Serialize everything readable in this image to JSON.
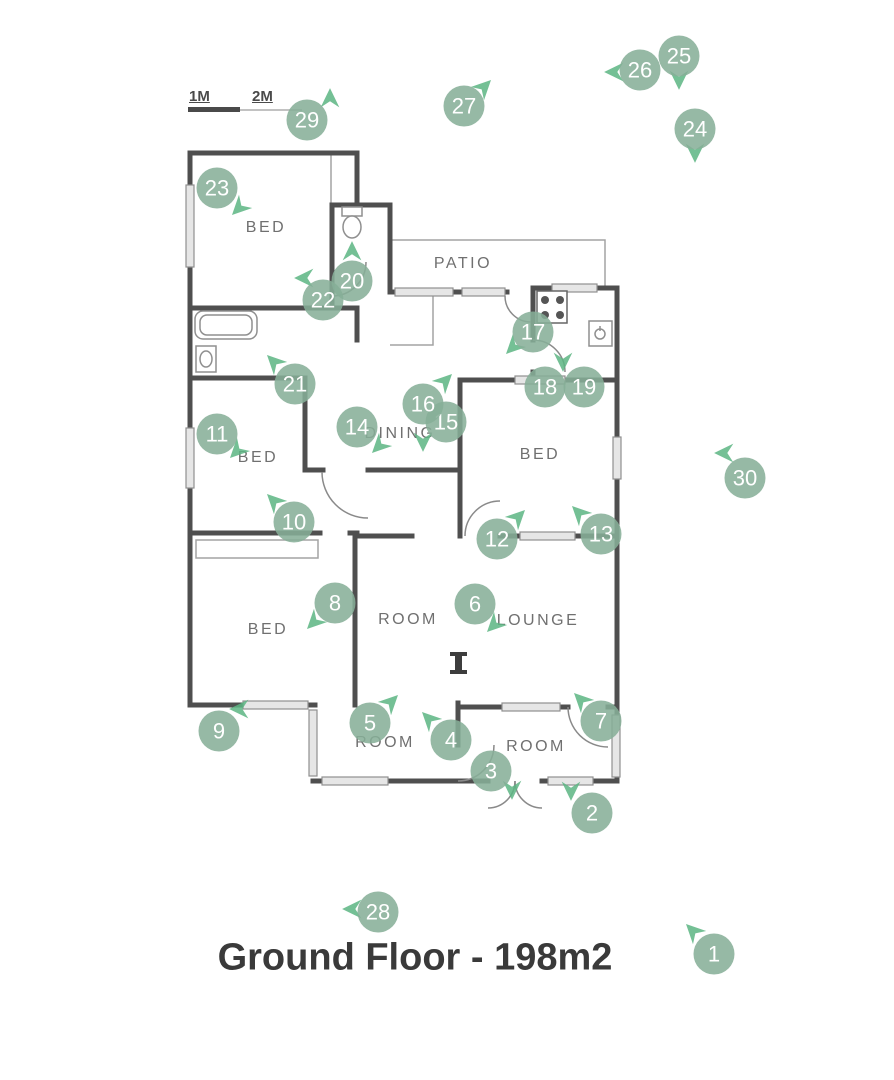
{
  "title": {
    "text": "Ground Floor - 198m2"
  },
  "scale_bar": {
    "label_1m": "1M",
    "label_2m": "2M"
  },
  "colors": {
    "marker_fill": "rgba(134,175,152,0.87)",
    "arrow_fill": "rgba(92,181,131,0.85)",
    "wall": "#4f4f4f",
    "room_label": "#707070",
    "title_text": "#3a3a3a"
  },
  "rooms": [
    {
      "id": "bed-top-left",
      "label": "BED",
      "x": 266,
      "y": 228
    },
    {
      "id": "patio",
      "label": "PATIO",
      "x": 463,
      "y": 264
    },
    {
      "id": "dining",
      "label": "DINING",
      "x": 400,
      "y": 434
    },
    {
      "id": "bed-right",
      "label": "BED",
      "x": 540,
      "y": 455
    },
    {
      "id": "bed-mid-left",
      "label": "BED",
      "x": 258,
      "y": 458
    },
    {
      "id": "bed-bottom-left",
      "label": "BED",
      "x": 268,
      "y": 630
    },
    {
      "id": "room-center",
      "label": "ROOM",
      "x": 408,
      "y": 620
    },
    {
      "id": "lounge",
      "label": "LOUNGE",
      "x": 538,
      "y": 621
    },
    {
      "id": "room-bottom-center",
      "label": "ROOM",
      "x": 385,
      "y": 743
    },
    {
      "id": "room-bottom-right",
      "label": "ROOM",
      "x": 536,
      "y": 747
    }
  ],
  "markers": [
    {
      "n": "1",
      "x": 714,
      "y": 954,
      "arrow": {
        "dx": -21,
        "dy": -23,
        "dir": "NW"
      }
    },
    {
      "n": "2",
      "x": 592,
      "y": 813,
      "arrow": {
        "dx": -21,
        "dy": -22,
        "dir": "S"
      }
    },
    {
      "n": "3",
      "x": 491,
      "y": 771,
      "arrow": {
        "dx": 21,
        "dy": 19,
        "dir": "S"
      }
    },
    {
      "n": "4",
      "x": 451,
      "y": 740,
      "arrow": {
        "dx": -22,
        "dy": -21,
        "dir": "NW"
      }
    },
    {
      "n": "5",
      "x": 370,
      "y": 723,
      "arrow": {
        "dx": 21,
        "dy": -21,
        "dir": "NE"
      }
    },
    {
      "n": "6",
      "x": 475,
      "y": 604,
      "arrow": {
        "dx": 19,
        "dy": 21,
        "dir": "SW"
      }
    },
    {
      "n": "7",
      "x": 601,
      "y": 721,
      "arrow": {
        "dx": -20,
        "dy": -21,
        "dir": "NW"
      }
    },
    {
      "n": "8",
      "x": 335,
      "y": 603,
      "arrow": {
        "dx": -21,
        "dy": 19,
        "dir": "SW"
      }
    },
    {
      "n": "9",
      "x": 219,
      "y": 731,
      "arrow": {
        "dx": 20,
        "dy": -22,
        "dir": "W"
      }
    },
    {
      "n": "10",
      "x": 294,
      "y": 522,
      "arrow": {
        "dx": -20,
        "dy": -21,
        "dir": "NW"
      }
    },
    {
      "n": "11",
      "x": 217,
      "y": 434,
      "arrow": {
        "dx": 20,
        "dy": 17,
        "dir": "SW"
      }
    },
    {
      "n": "12",
      "x": 497,
      "y": 539,
      "arrow": {
        "dx": 21,
        "dy": -22,
        "dir": "NE"
      }
    },
    {
      "n": "13",
      "x": 601,
      "y": 534,
      "arrow": {
        "dx": -22,
        "dy": -21,
        "dir": "NW"
      }
    },
    {
      "n": "14",
      "x": 357,
      "y": 427,
      "arrow": {
        "dx": 22,
        "dy": 19,
        "dir": "SW"
      }
    },
    {
      "n": "15",
      "x": 446,
      "y": 422,
      "arrow": {
        "dx": -23,
        "dy": 20,
        "dir": "S"
      }
    },
    {
      "n": "16",
      "x": 423,
      "y": 404,
      "arrow": {
        "dx": 22,
        "dy": -23,
        "dir": "NE"
      }
    },
    {
      "n": "17",
      "x": 533,
      "y": 332,
      "arrow": {
        "dx": -20,
        "dy": 15,
        "dir": "SW"
      }
    },
    {
      "n": "18",
      "x": 545,
      "y": 387,
      "arrow": {
        "dx": 18,
        "dy": -25,
        "dir": "S"
      }
    },
    {
      "n": "19",
      "x": 584,
      "y": 387,
      "arrow": null
    },
    {
      "n": "20",
      "x": 352,
      "y": 281,
      "arrow": {
        "dx": 0,
        "dy": -30,
        "dir": "N"
      }
    },
    {
      "n": "21",
      "x": 295,
      "y": 384,
      "arrow": {
        "dx": -21,
        "dy": -22,
        "dir": "NW"
      }
    },
    {
      "n": "22",
      "x": 323,
      "y": 300,
      "arrow": {
        "dx": -19,
        "dy": -22,
        "dir": "W"
      }
    },
    {
      "n": "23",
      "x": 217,
      "y": 188,
      "arrow": {
        "dx": 22,
        "dy": 20,
        "dir": "SW"
      }
    },
    {
      "n": "24",
      "x": 695,
      "y": 129,
      "arrow": {
        "dx": 0,
        "dy": 24,
        "dir": "S"
      }
    },
    {
      "n": "25",
      "x": 679,
      "y": 56,
      "arrow": {
        "dx": 0,
        "dy": 24,
        "dir": "S"
      }
    },
    {
      "n": "26",
      "x": 640,
      "y": 70,
      "arrow": {
        "dx": -26,
        "dy": 2,
        "dir": "W"
      }
    },
    {
      "n": "27",
      "x": 464,
      "y": 106,
      "arrow": {
        "dx": 20,
        "dy": -19,
        "dir": "NE"
      }
    },
    {
      "n": "28",
      "x": 378,
      "y": 912,
      "arrow": {
        "dx": -26,
        "dy": -3,
        "dir": "W"
      }
    },
    {
      "n": "29",
      "x": 307,
      "y": 120,
      "arrow": {
        "dx": 23,
        "dy": -22,
        "dir": "N"
      }
    },
    {
      "n": "30",
      "x": 745,
      "y": 478,
      "arrow": {
        "dx": -21,
        "dy": -25,
        "dir": "W"
      }
    }
  ]
}
